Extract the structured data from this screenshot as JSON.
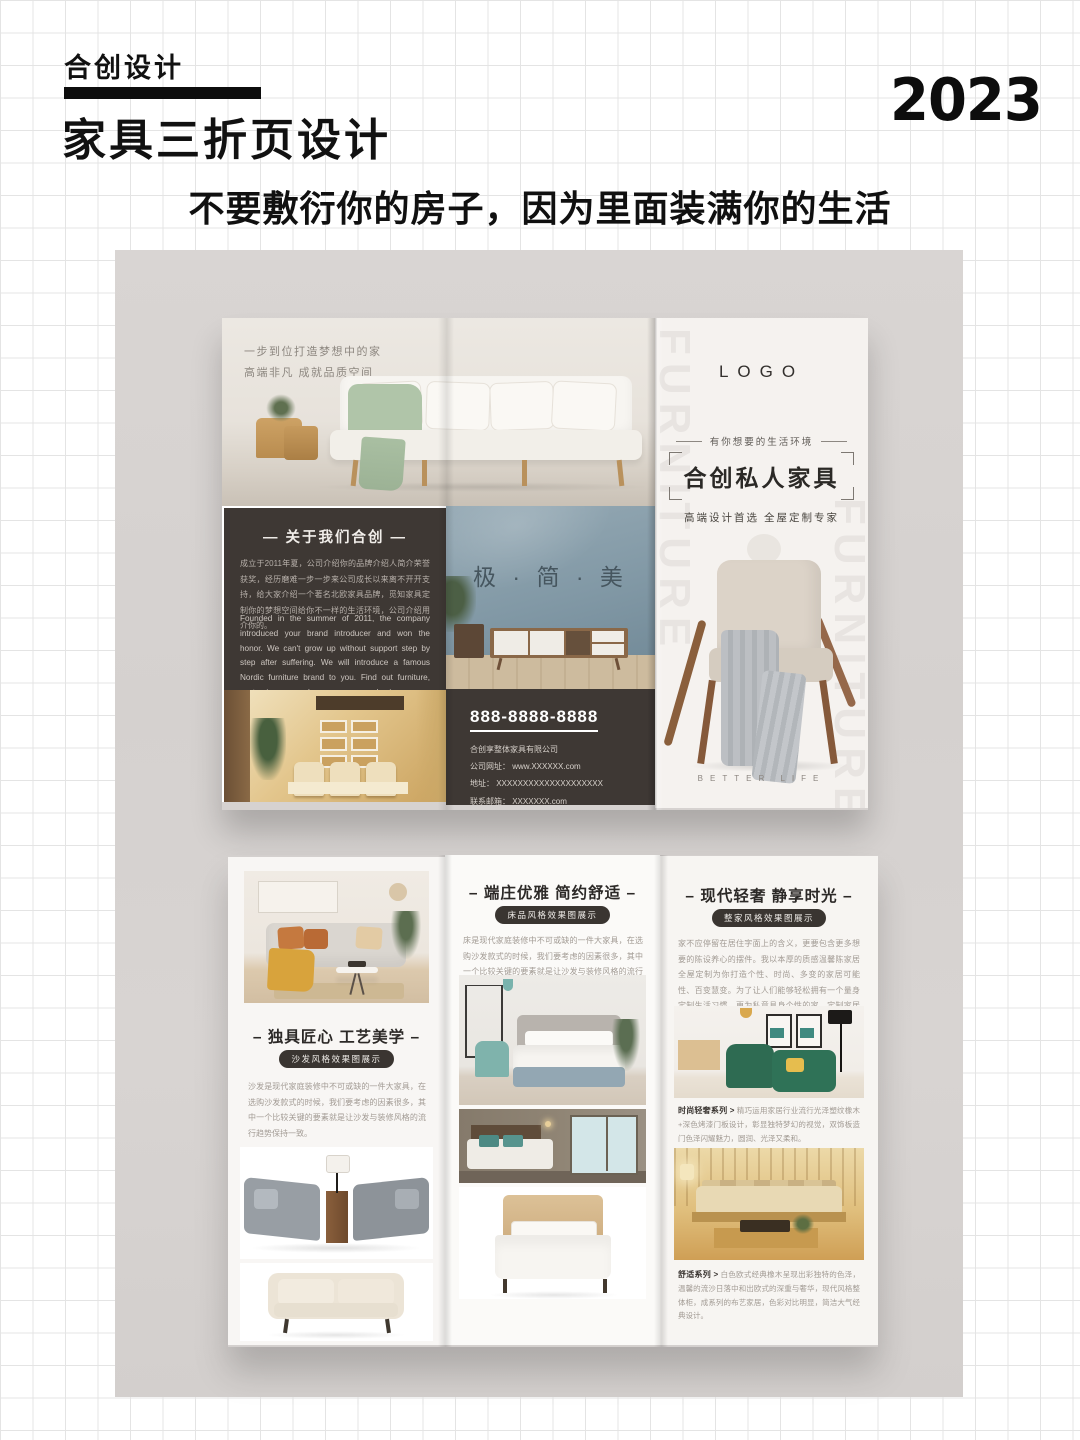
{
  "page": {
    "brand": "合创设计",
    "title": "家具三折页设计",
    "year": "2023",
    "subtitle": "不要敷衍你的房子，因为里面装满你的生活"
  },
  "front": {
    "intro_line1": "一步到位打造梦想中的家",
    "intro_line2": "高端非凡  成就品质空间",
    "about_heading": "— 关于我们合创 —",
    "about_cn": "成立于2011年夏，公司介绍你的品牌介绍人简介荣誉获奖，经历磨难一步一步来公司成长以来离不开开支持，给大家介绍一个著名北欧家具品牌，觅知家具定制你的梦想空间给你不一样的生活环境，公司介绍用介你的。",
    "about_en": "Founded in the summer of 2011, the company introduced your brand introducer and won the honor. We can't grow up without support step by step after suffering. We will introduce a famous Nordic furniture brand to you. Find out furniture, customize your dream space, and give you a different living environment. The company introduces you.",
    "slogan": "极 · 简 · 美",
    "phone": "888-8888-8888",
    "company": "合创享整体家具有限公司",
    "website": "公司网址： www.XXXXXX.com",
    "address": "地址： XXXXXXXXXXXXXXXXXXXX",
    "email": "联系邮箱： XXXXXXX.com",
    "logo": "LOGO",
    "tagline": "有你想要的生活环境",
    "cover_title": "合创私人家具",
    "cover_sub": "高端设计首选 全屋定制专家",
    "better_life": "BETTER LIFE",
    "watermark": "FURNITURE"
  },
  "back": {
    "left": {
      "heading": "– 独具匠心 工艺美学 –",
      "badge": "沙发风格效果图展示",
      "body": "沙发是现代家庭装修中不可或缺的一件大家具，在选购沙发款式的时候，我们要考虑的因素很多，其中一个比较关键的要素就是让沙发与装修风格的流行趋势保持一致。"
    },
    "middle": {
      "heading": "– 端庄优雅 简约舒适 –",
      "badge": "床品风格效果图展示",
      "body": "床是现代家庭装修中不可或缺的一件大家具，在选购沙发款式的时候，我们要考虑的因素很多，其中一个比较关键的要素就是让沙发与装修风格的流行趋势保持一致。"
    },
    "right": {
      "heading": "– 现代轻奢 静享时光 –",
      "badge": "整家风格效果图展示",
      "body": "家不应停留在居住字面上的含义，更要包含更多想要的陈设养心的摆件。我以本厚的质感温馨陈家居全屋定制为你打造个性、时尚、多变的家居可能性、百变慧变。为了让人们能够轻松拥有一个量身定制生活习惯、更为私意具身个性的家，定制家居推出了整体家居、木门、墙面柜体一体化定制，实现家的无限可能。",
      "caption1_label": "时尚轻奢系列 >",
      "caption1": "精巧运用家居行业流行光泽塑纹橡木+深色烤漆门板设计，彰显独特梦幻的视觉，双饰板造门色泽闪耀魅力，圆润、光泽又柔和。",
      "caption2_label": "舒适系列 >",
      "caption2": "白色欧式经典橡木呈现出彩独特的色泽，温馨的流沙日落中和出欧式的深重与奢华，现代风格整体柜，成系列的布艺家居，色彩对比明显，简洁大气经典设计。"
    }
  },
  "colors": {
    "dark_block": "#3e3834",
    "steel_blue_wall": "#8299a6",
    "backdrop_gray": "#d7d3d1",
    "paper": "#f5f2ef"
  }
}
